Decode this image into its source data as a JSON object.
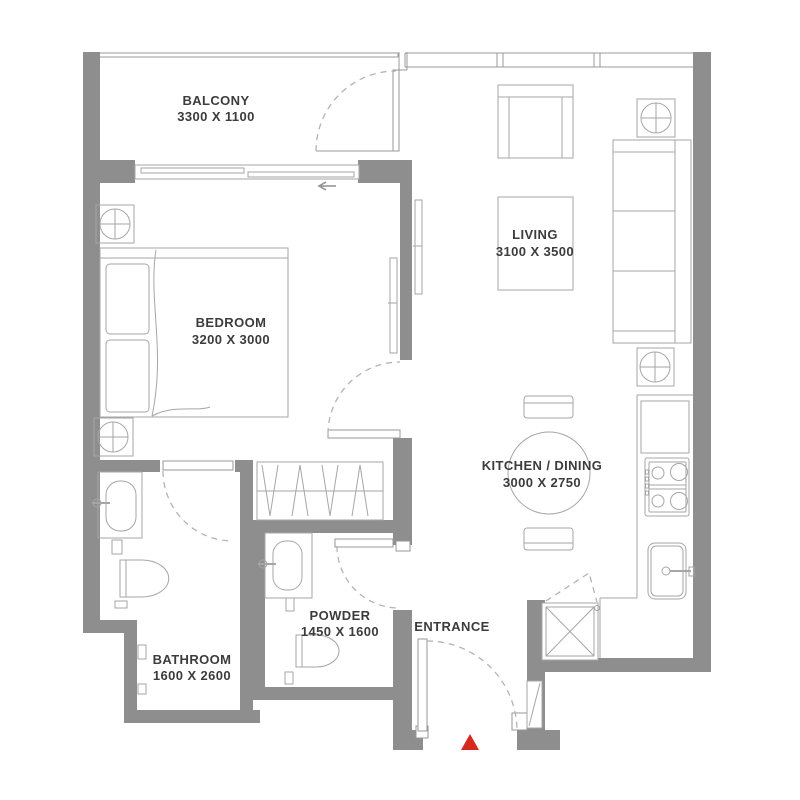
{
  "rooms": {
    "balcony": {
      "name": "BALCONY",
      "dims": "3300 X 1100"
    },
    "bedroom": {
      "name": "BEDROOM",
      "dims": "3200 X 3000"
    },
    "living": {
      "name": "LIVING",
      "dims": "3100 X 3500"
    },
    "kitchen_dining": {
      "name": "KITCHEN / DINING",
      "dims": "3000 X 2750"
    },
    "bathroom": {
      "name": "BATHROOM",
      "dims": "1600 X 2600"
    },
    "powder": {
      "name": "POWDER",
      "dims": "1450 X 1600"
    },
    "entrance": {
      "name": "ENTRANCE"
    }
  },
  "colors": {
    "wall": "#8e8e8e",
    "line": "#a6a6a6",
    "dash": "#b3b3b3",
    "text": "#3c3c3c",
    "entrance_marker": "#d7281e",
    "background": "#ffffff"
  }
}
